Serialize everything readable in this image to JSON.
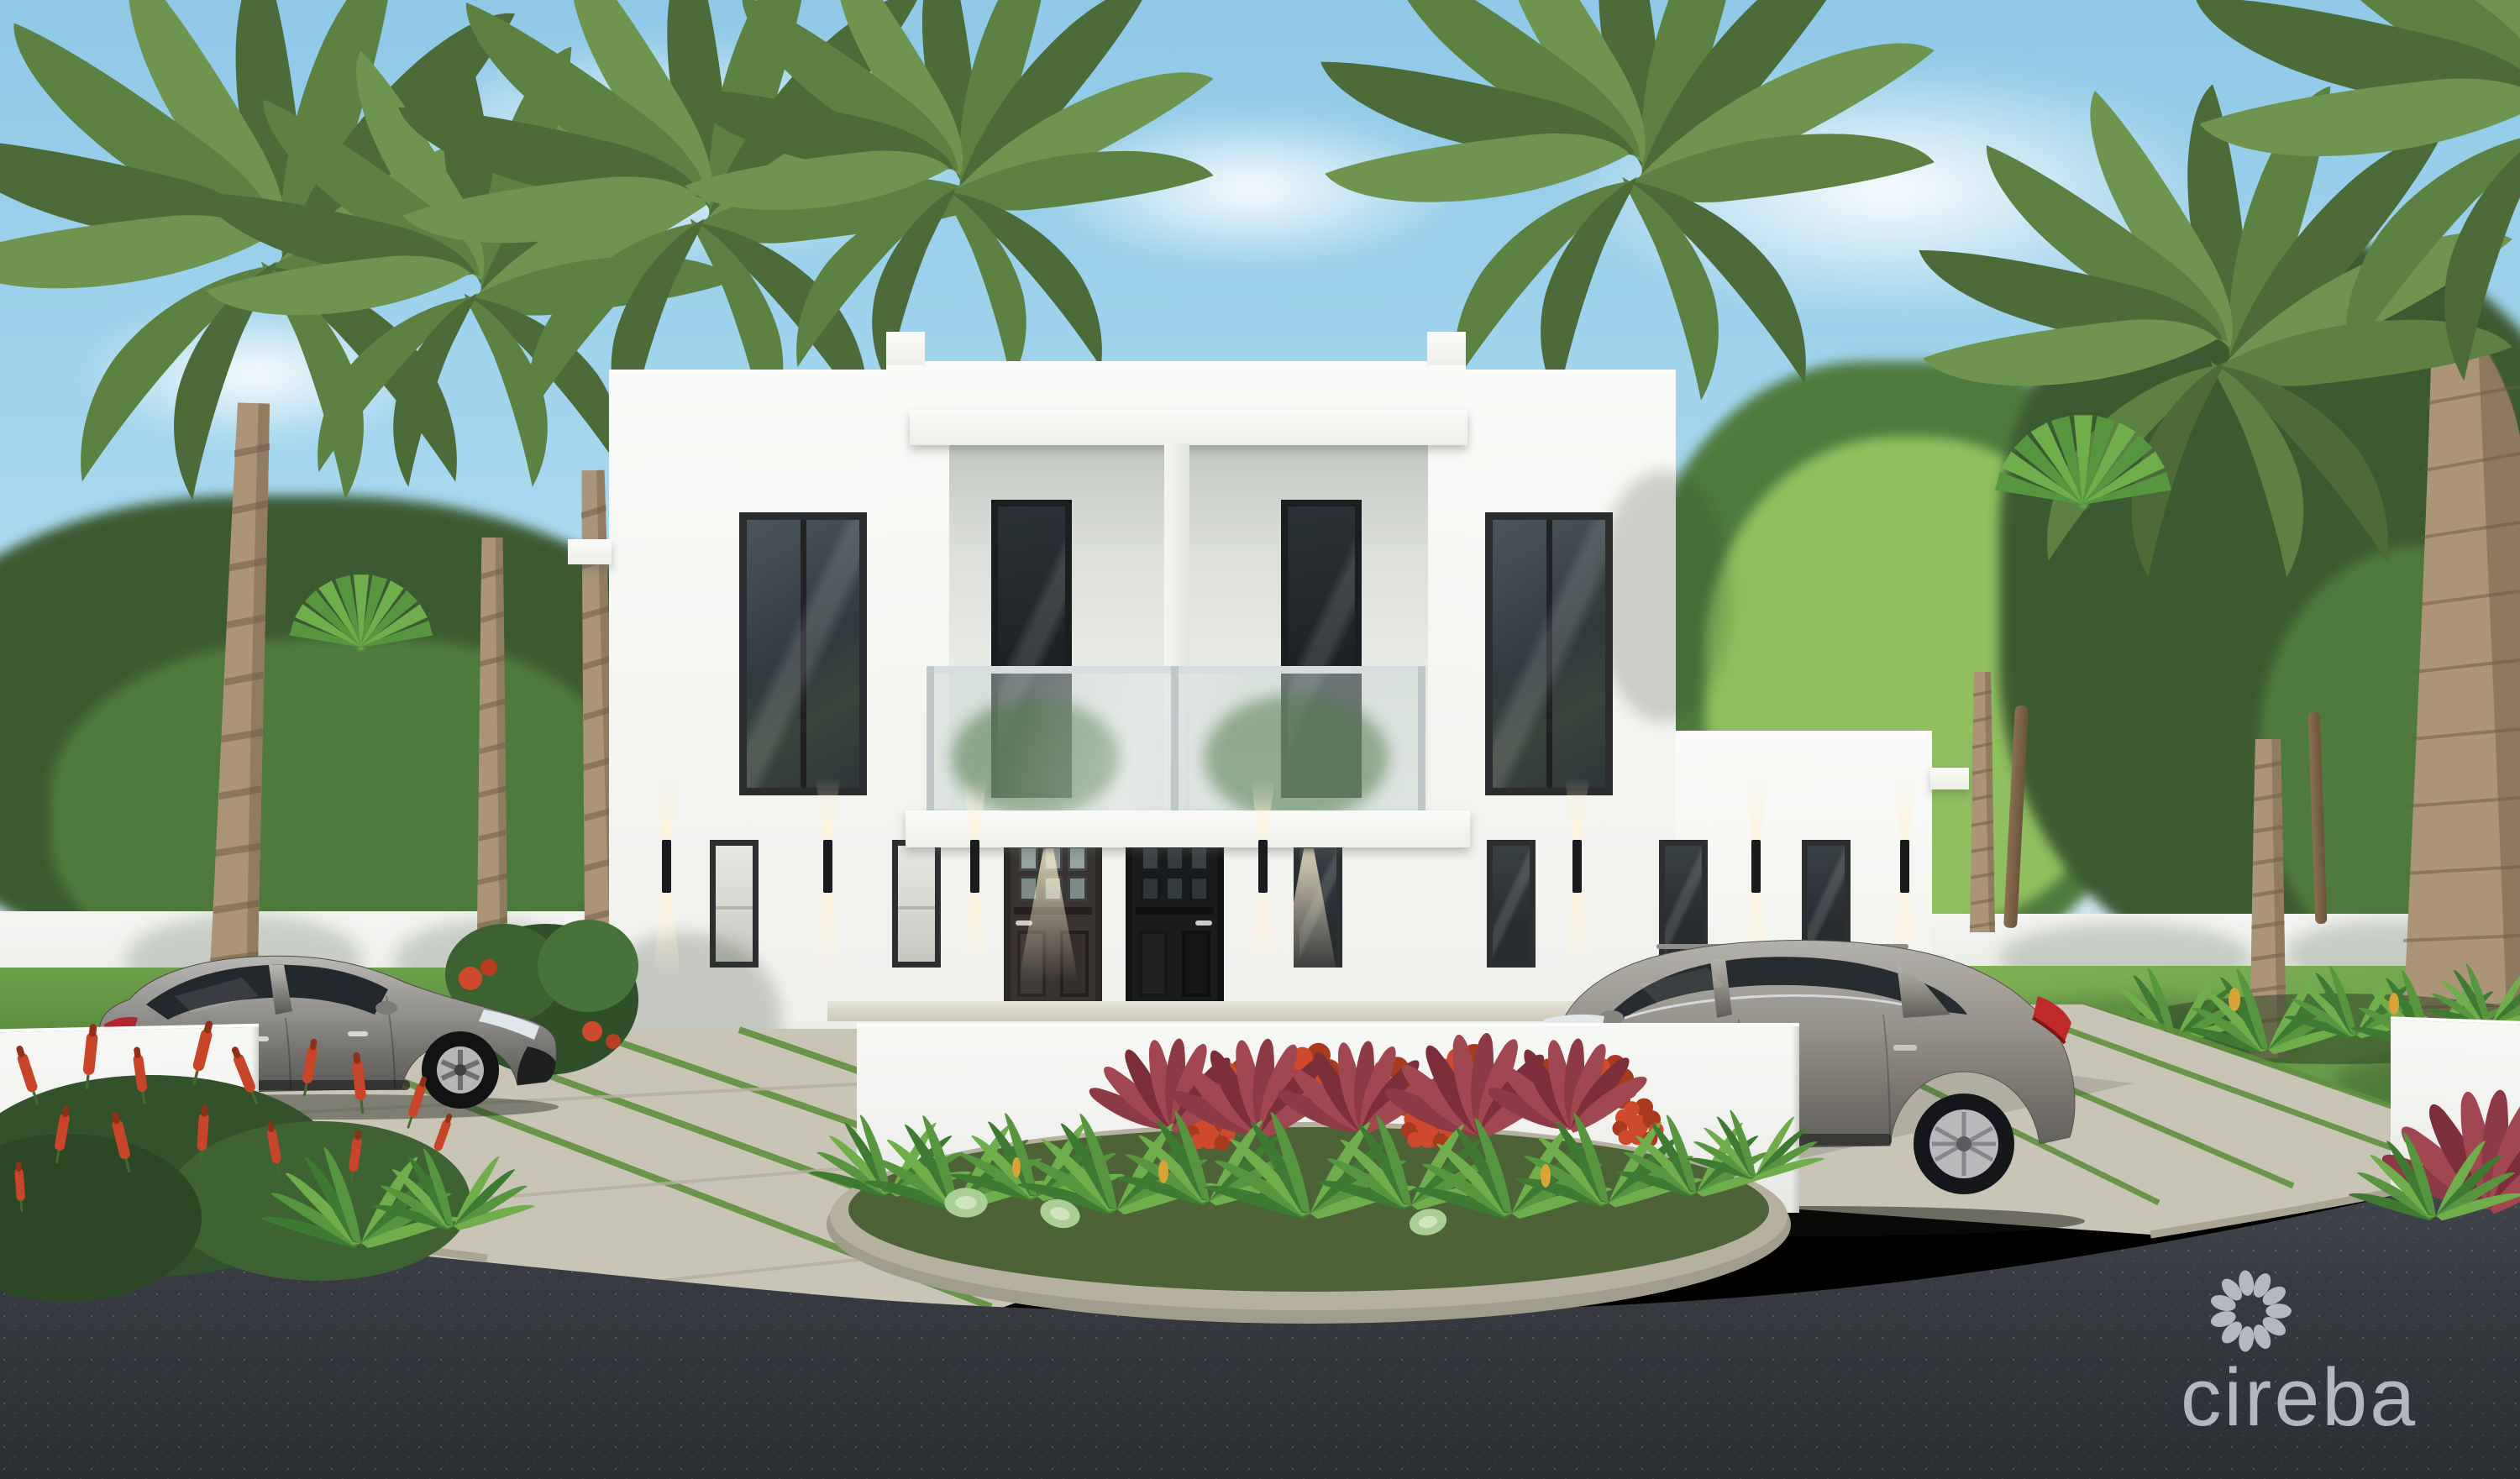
{
  "watermark": {
    "text": "cireba",
    "icon": "petal-ring-logo",
    "color": "#c5cad1"
  },
  "palette": {
    "sky_top": "#8fc9e7",
    "sky_horizon": "#d2eaf5",
    "tree_dark": "#3c5a31",
    "tree_mid": "#4f7a3d",
    "tree_light": "#79a950",
    "tree_lime": "#8fbf5e",
    "frond_dark": "#4c6b38",
    "frond_mid": "#5c8143",
    "frond_light": "#6f9450",
    "trunk_tan": "#ab9478",
    "trunk_shade": "#7c6750",
    "house_white": "#f5f5f2",
    "recess_top": "#e7e9e4",
    "frame_dark": "#2a2c2e",
    "door_brown": "#3a3430",
    "door_black": "#1a1b1d",
    "rail_metal": "#c2c9cb",
    "porch": "#d3cfc2",
    "wall_white": "#f2f3f0",
    "fence_white": "#eceeea",
    "grass_bright": "#7fb254",
    "paver": "#c8c4b6",
    "paver_joint": "#5f8f3f",
    "curb": "#b5b0a0",
    "asphalt_top": "#3a3e44",
    "asphalt_deep": "#2b2e33",
    "flower_red": "#cf4a2c",
    "ti_leaf": "#a14752",
    "car_gray": "#97958f",
    "taillight": "#c12a2a",
    "sconce_body": "#1a1b1d",
    "glow": "#ffeec8"
  }
}
